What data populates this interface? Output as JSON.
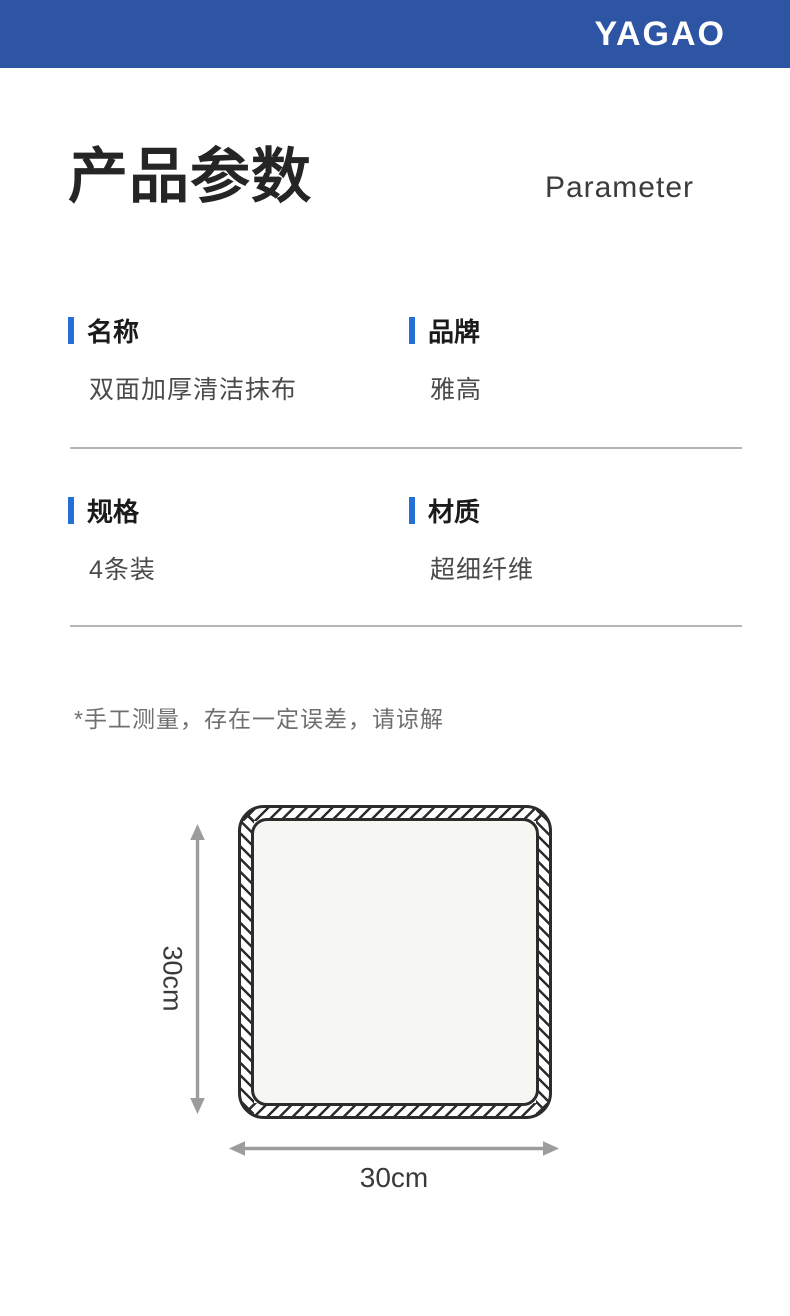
{
  "header": {
    "brand": "YAGAO"
  },
  "title": {
    "zh": "产品参数",
    "en": "Parameter"
  },
  "params": [
    {
      "label": "名称",
      "value": "双面加厚清洁抹布"
    },
    {
      "label": "品牌",
      "value": "雅高"
    },
    {
      "label": "规格",
      "value": "4条装"
    },
    {
      "label": "材质",
      "value": "超细纤维"
    }
  ],
  "note": "*手工测量，存在一定误差，请谅解",
  "diagram": {
    "height_label": "30cm",
    "width_label": "30cm"
  },
  "colors": {
    "header_blue": "#2e54a4",
    "accent_blue": "#2470d8",
    "divider_gray": "#b4b4b4",
    "arrow_gray": "#9c9c9c"
  }
}
